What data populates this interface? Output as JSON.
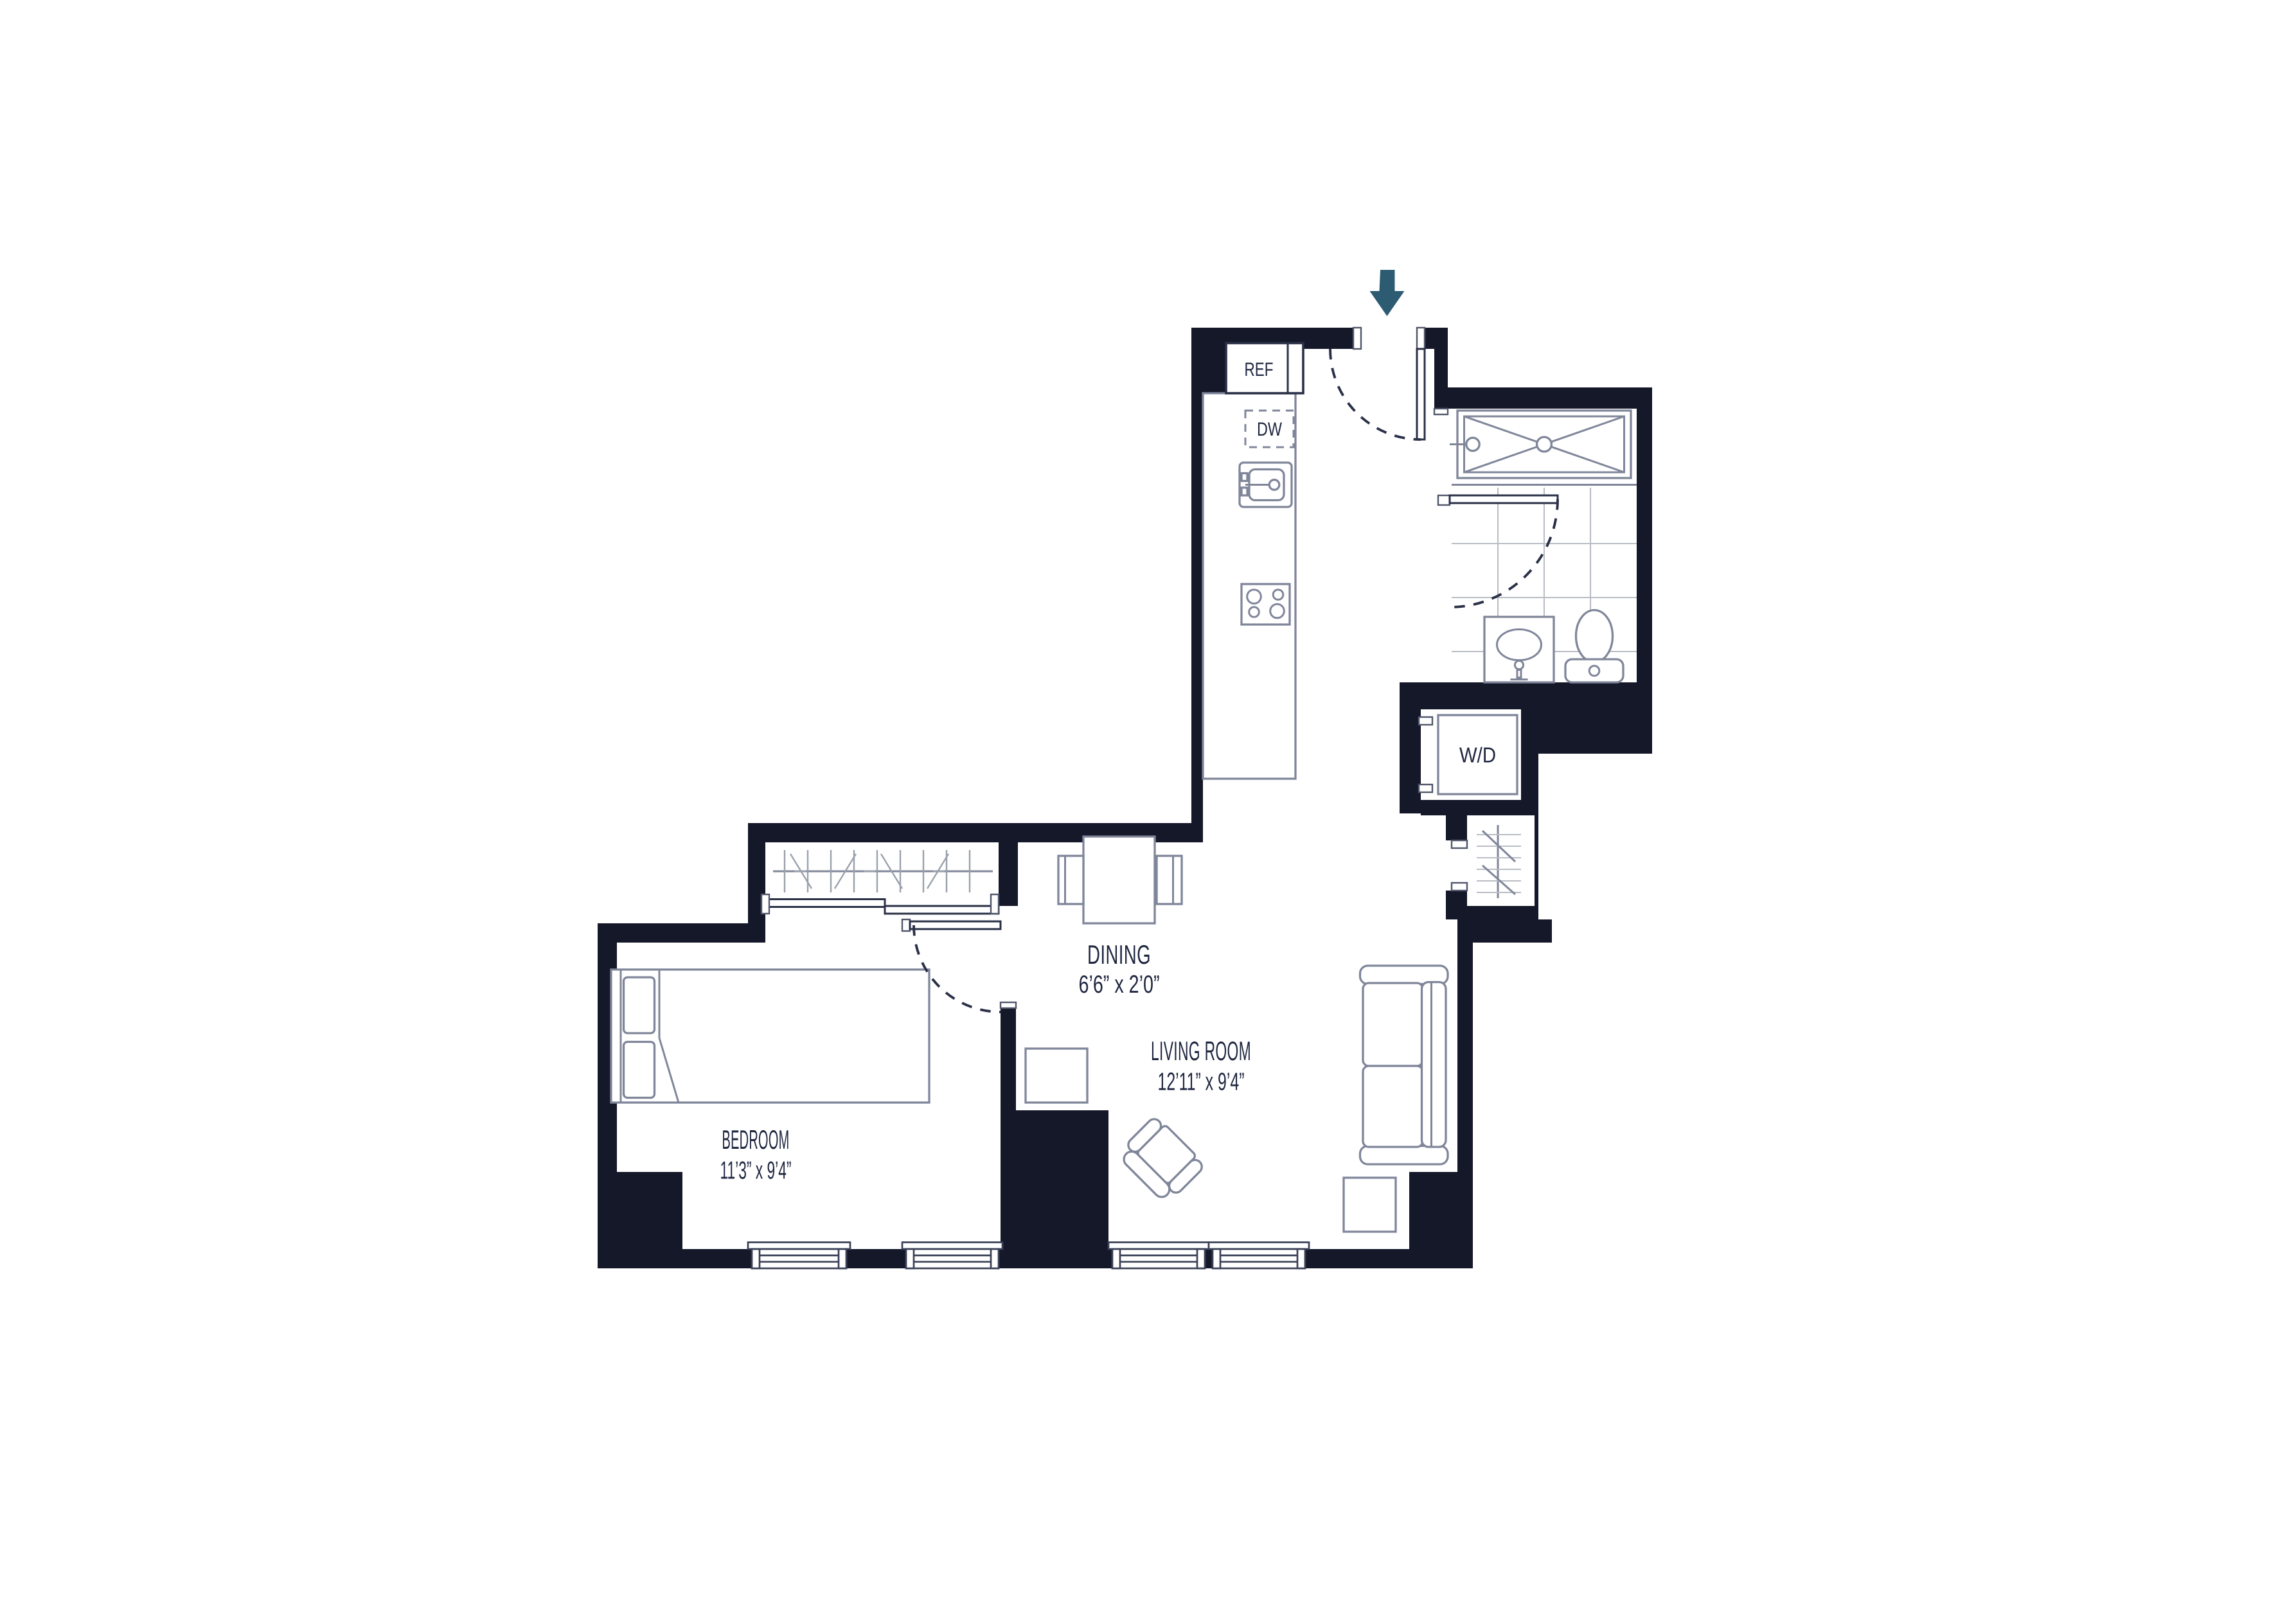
{
  "plan": {
    "rooms": {
      "dining": {
        "name": "DINING",
        "dims": "6’6” x 2’0”"
      },
      "living": {
        "name": "LIVING ROOM",
        "dims": "12’11” x 9’4”"
      },
      "bedroom": {
        "name": "BEDROOM",
        "dims": "11’3” x 9’4”"
      }
    },
    "fixtures": {
      "refrigerator": "REF",
      "dishwasher": "DW",
      "washer_dryer": "W/D"
    },
    "icons": {
      "entry_arrow": "down-arrow"
    },
    "colors": {
      "wall": "#151828",
      "furniture_line": "#80869a",
      "tile_line": "#b9bdc4",
      "text": "#1f2640",
      "entry_arrow": "#2d5c72"
    }
  }
}
